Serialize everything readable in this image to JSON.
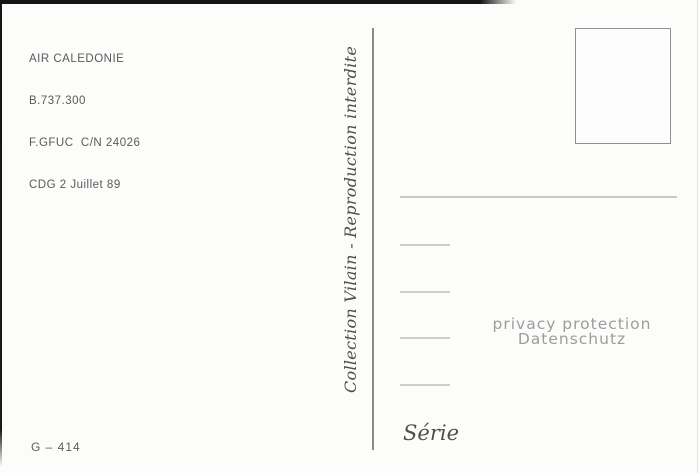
{
  "postcard": {
    "publisher_block": {
      "lines": [
        "AIR CALEDONIE",
        "B.737.300",
        "F.GFUC  C/N 24026",
        "CDG 2 Juillet 89"
      ]
    },
    "spine": {
      "text": "Collection Vilain - Reproduction interdite"
    },
    "stamp_box": {
      "present": "empty rectangle for stamp"
    },
    "address_area": {
      "long_line_count": 1,
      "stub_line_count": 4
    },
    "watermark": {
      "line1": "privacy protection",
      "line2": "Datenschutz"
    },
    "series": {
      "label": "Série"
    },
    "catalog": {
      "number": "G – 414"
    },
    "colors": {
      "card_background": "#fcfcfb",
      "publisher_text": "#5a5a5a",
      "spine_text": "#4e4e4e",
      "divider": "#8a8a8a",
      "stamp_border": "#909090",
      "address_line": "#c8c8c8",
      "watermark_text": "#9d9d9d",
      "catalog_text": "#5e5e5e",
      "scan_edge": "#141414"
    }
  }
}
